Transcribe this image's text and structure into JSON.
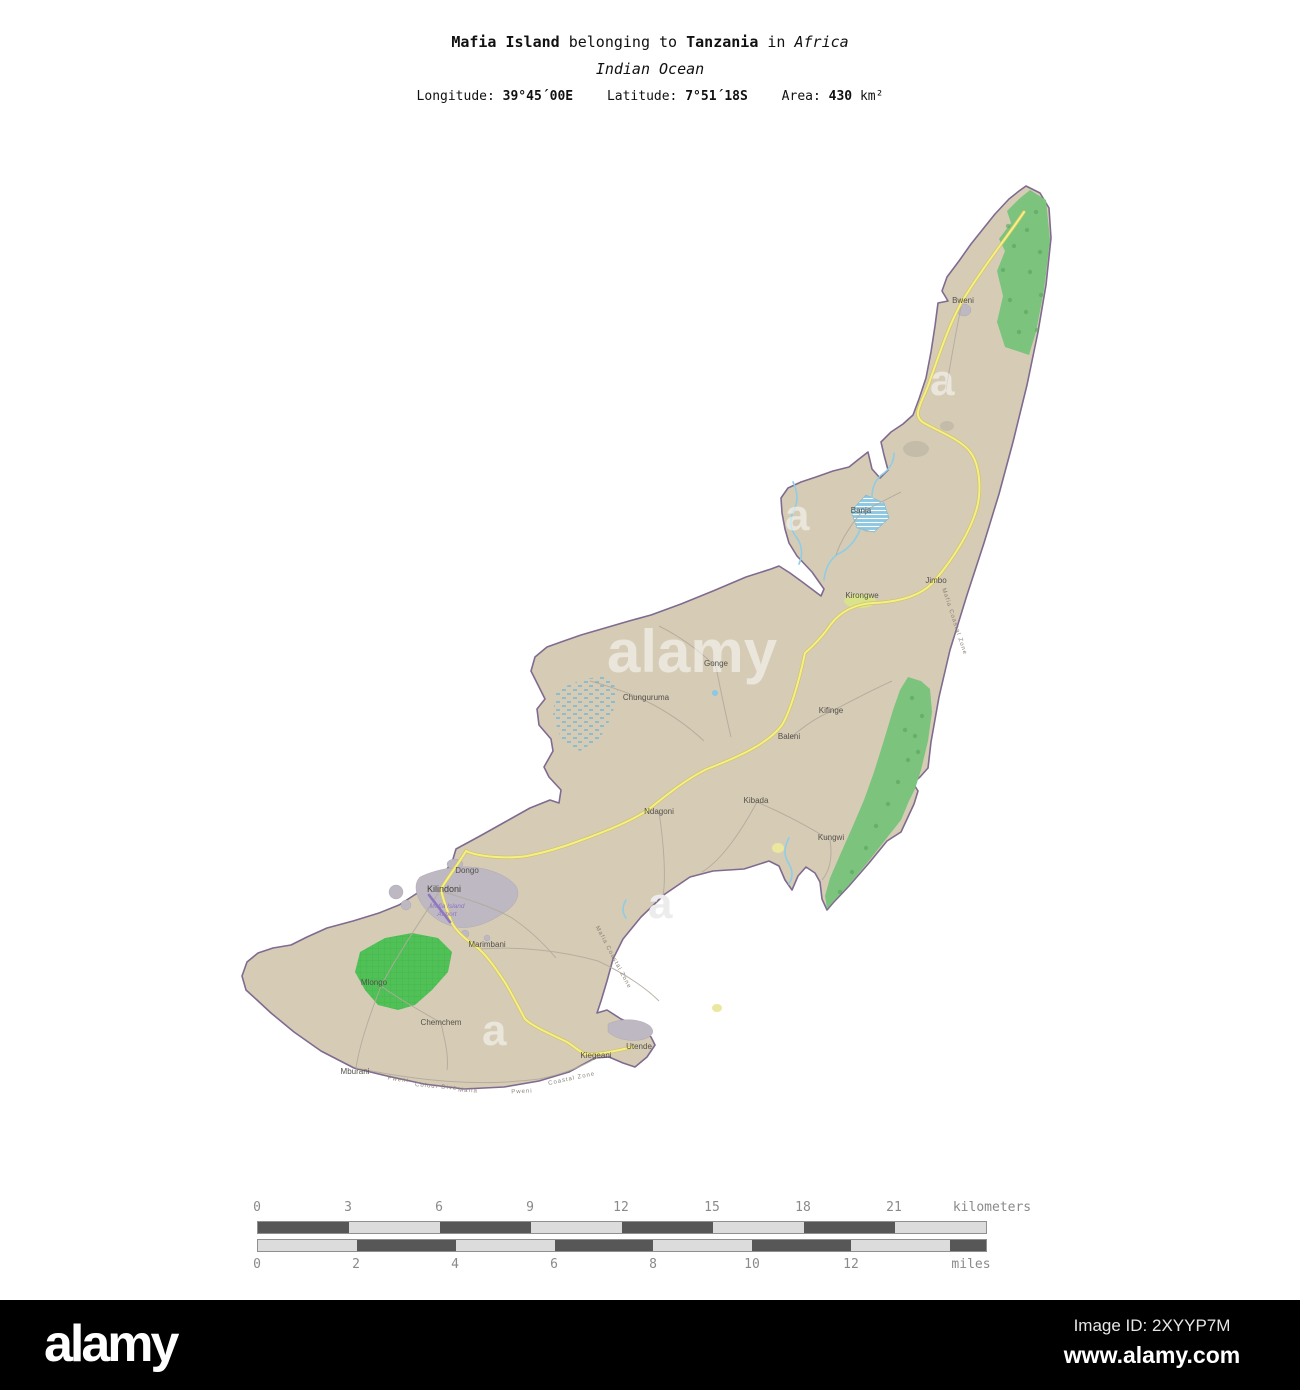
{
  "title": {
    "name": "Mafia Island",
    "belonging": "belonging to",
    "country": "Tanzania",
    "in": "in",
    "continent": "Africa",
    "subtitle": "Indian Ocean",
    "longitude_label": "Longitude:",
    "longitude": "39°45´00E",
    "latitude_label": "Latitude:",
    "latitude": "7°51´18S",
    "area_label": "Area:",
    "area_value": "430",
    "area_unit": "km²"
  },
  "map": {
    "labels": [
      {
        "name": "Bweni"
      },
      {
        "name": "Banja"
      },
      {
        "name": "Jimbo"
      },
      {
        "name": "Kirongwe"
      },
      {
        "name": "Gonge"
      },
      {
        "name": "Chunguruma"
      },
      {
        "name": "Kifinge"
      },
      {
        "name": "Baleni"
      },
      {
        "name": "Kibada"
      },
      {
        "name": "Ndagoni"
      },
      {
        "name": "Kungwi"
      },
      {
        "name": "Dongo"
      },
      {
        "name": "Kilindoni"
      },
      {
        "name": "Marimbani"
      },
      {
        "name": "Mlongo"
      },
      {
        "name": "Chemchem"
      },
      {
        "name": "Mburani"
      },
      {
        "name": "Kiegeani"
      },
      {
        "name": "Utende"
      }
    ],
    "airport": {
      "line1": "Mafia Island",
      "line2": "Airport"
    },
    "coast_labels": [
      "Mafia Coastal Zone",
      "Mafia Coastal Zone",
      "Pweni",
      "Colour Dive",
      "Mafia",
      "Pweni",
      "Coastal Zone"
    ],
    "colors": {
      "land": "#d6ccb6",
      "coastline": "#7e6b8f",
      "forest": "#7cc47d",
      "forest-dot": "#54a05c",
      "park": "#4fc157",
      "water": "#8cc8e2",
      "stream": "#8ecde4",
      "urban": "#bdb8c2",
      "road": "#f6ef86",
      "road-casing": "#cfc465",
      "minor-road": "#b3aa9c",
      "airport": "#8f76c0",
      "label": "#54504a",
      "scale-dark": "#575757",
      "scale-light": "#dcdcdc",
      "scale-text": "#8a8a8a"
    }
  },
  "scalebar": {
    "km_ticks": [
      "0",
      "3",
      "6",
      "9",
      "12",
      "15",
      "18",
      "21"
    ],
    "km_unit": "kilometers",
    "mi_ticks": [
      "0",
      "2",
      "4",
      "6",
      "8",
      "10",
      "12"
    ],
    "mi_unit": "miles"
  },
  "watermark": {
    "text": "alamy",
    "letter": "a"
  },
  "footer": {
    "logo": "alamy",
    "image_id": "Image ID: 2XYYP7M",
    "url": "www.alamy.com"
  }
}
